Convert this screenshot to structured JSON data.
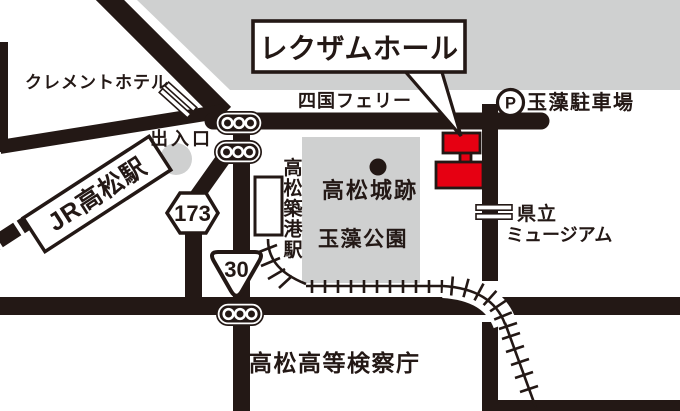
{
  "callout": {
    "label": "レクザムホール"
  },
  "stations": {
    "jr": "JR高松駅",
    "kotoden": "高松築港駅"
  },
  "places": {
    "hotel": "クレメントホテル",
    "exit": "出入口",
    "ferry": "四国フェリー",
    "parking": "玉藻駐車場",
    "castle": "高松城跡",
    "park": "玉藻公園",
    "museum_line1": "県立",
    "museum_line2": "ミュージアム",
    "prosecutors": "高松高等検察庁"
  },
  "route_badges": {
    "route173": "173",
    "route30": "30"
  },
  "icons": {
    "parking_p": "P"
  },
  "colors": {
    "line_dark": "#231815",
    "area_gray": "#cfd0d0",
    "building_red": "#e60012",
    "white": "#ffffff"
  }
}
